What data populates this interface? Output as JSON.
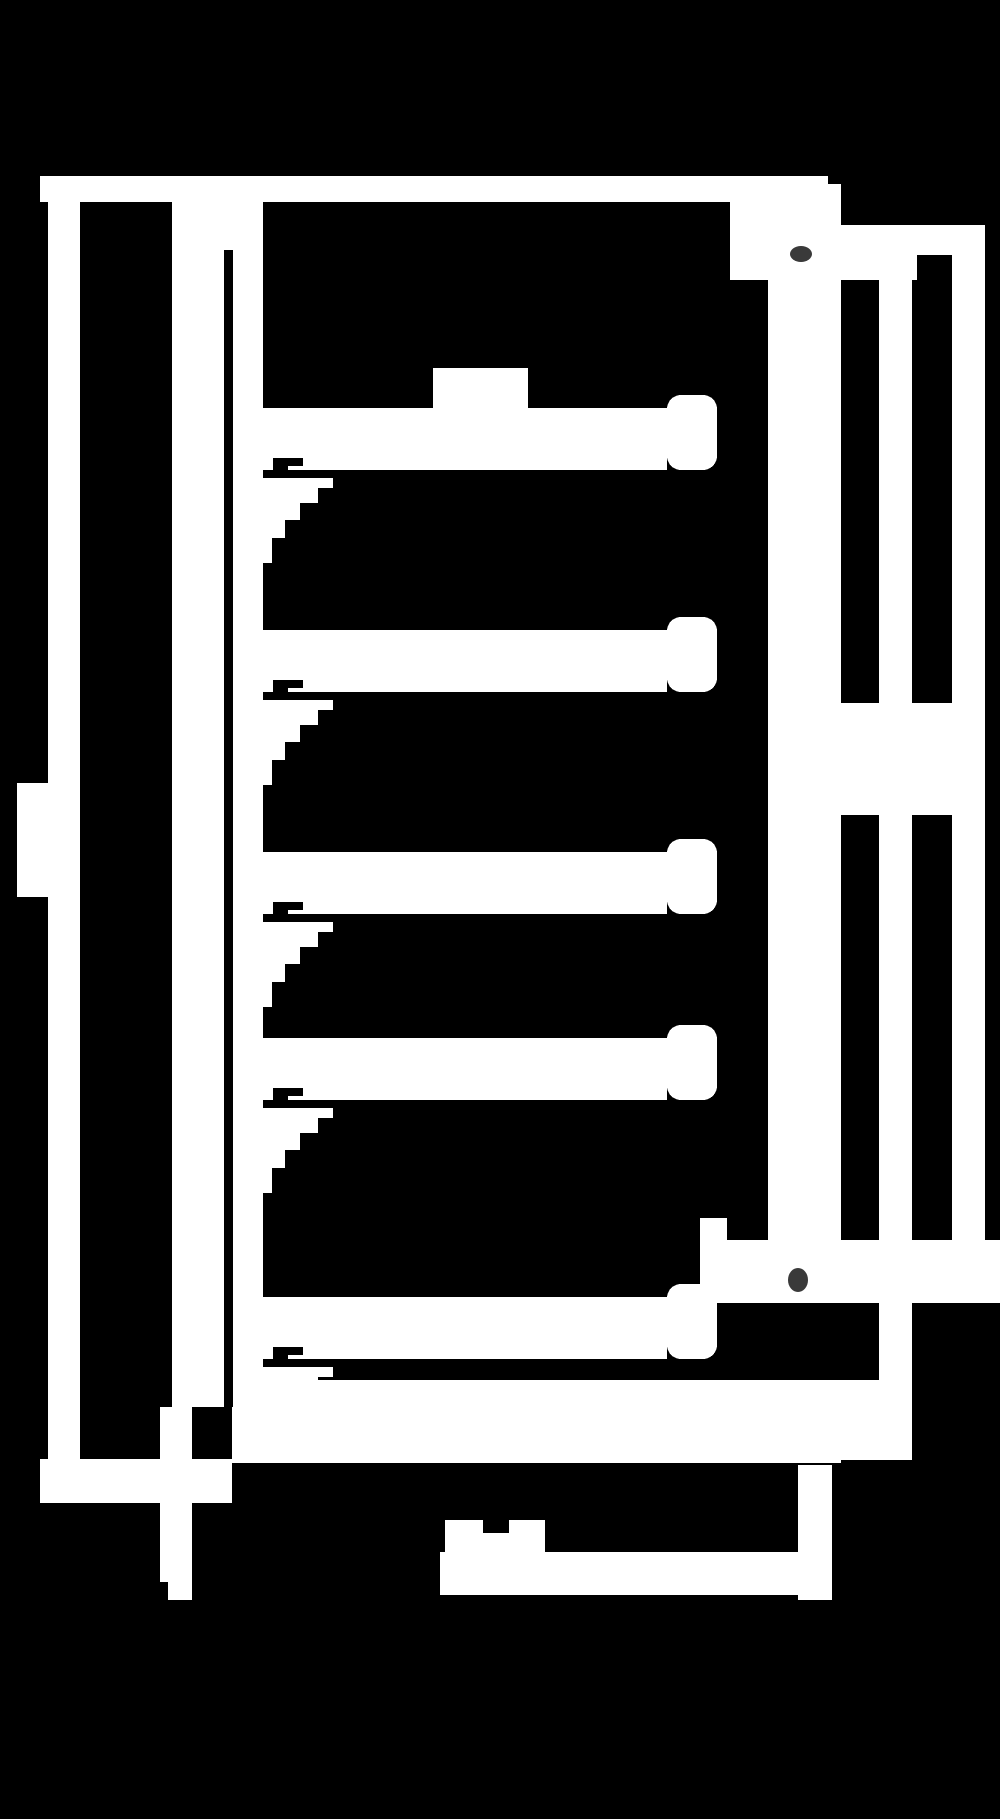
{
  "canvas": {
    "width": 1000,
    "height": 1819,
    "background_color": "#000000",
    "line_color": "#ffffff",
    "artifact_color": "#3a3a3a"
  },
  "diagram": {
    "type": "technical-drawing",
    "style": "inverted monochrome blocky cross-section of a shelved cabinet",
    "text_labels": [],
    "shapes": [
      {
        "name": "top-band",
        "kind": "rect",
        "fill": "fg",
        "x": 40,
        "y": 176,
        "w": 788,
        "h": 26
      },
      {
        "name": "top-right-block",
        "kind": "rect",
        "fill": "fg",
        "x": 730,
        "y": 176,
        "w": 94,
        "h": 104
      },
      {
        "name": "top-right-step",
        "kind": "rect",
        "fill": "fg",
        "x": 824,
        "y": 184,
        "w": 17,
        "h": 96
      },
      {
        "name": "top-right-wing",
        "kind": "rect",
        "fill": "fg",
        "x": 841,
        "y": 225,
        "w": 144,
        "h": 55
      },
      {
        "name": "left-outer-wall",
        "kind": "rect",
        "fill": "fg",
        "x": 48,
        "y": 202,
        "w": 32,
        "h": 1257
      },
      {
        "name": "door-handle",
        "kind": "rect",
        "fill": "fg",
        "x": 17,
        "y": 783,
        "w": 31,
        "h": 114
      },
      {
        "name": "inner-left-panel",
        "kind": "rect",
        "fill": "fg",
        "x": 172,
        "y": 202,
        "w": 52,
        "h": 1205
      },
      {
        "name": "left-lining",
        "kind": "rect",
        "fill": "fg",
        "x": 233,
        "y": 202,
        "w": 30,
        "h": 1261
      },
      {
        "name": "left-lining-top-merge",
        "kind": "rect",
        "fill": "fg",
        "x": 172,
        "y": 202,
        "w": 91,
        "h": 48
      },
      {
        "name": "shelf-1-bar",
        "kind": "rect",
        "fill": "fg",
        "x": 263,
        "y": 408,
        "w": 404,
        "h": 62
      },
      {
        "name": "shelf-1-lip",
        "kind": "rect",
        "fill": "fg",
        "x": 667,
        "y": 395,
        "w": 50,
        "h": 75,
        "rx": 14
      },
      {
        "name": "shelf-1-block",
        "kind": "rect",
        "fill": "fg",
        "x": 433,
        "y": 368,
        "w": 95,
        "h": 40
      },
      {
        "name": "shelf-1-gusset",
        "kind": "polygon",
        "fill": "fg",
        "points": [
          [
            263,
            478
          ],
          [
            333,
            478
          ],
          [
            333,
            488
          ],
          [
            318,
            488
          ],
          [
            318,
            503
          ],
          [
            300,
            503
          ],
          [
            300,
            520
          ],
          [
            285,
            520
          ],
          [
            285,
            538
          ],
          [
            272,
            538
          ],
          [
            272,
            563
          ],
          [
            263,
            563
          ]
        ]
      },
      {
        "name": "shelf-2-bar",
        "kind": "rect",
        "fill": "fg",
        "x": 263,
        "y": 630,
        "w": 404,
        "h": 62
      },
      {
        "name": "shelf-2-lip",
        "kind": "rect",
        "fill": "fg",
        "x": 667,
        "y": 617,
        "w": 50,
        "h": 75,
        "rx": 14
      },
      {
        "name": "shelf-2-gusset",
        "kind": "polygon",
        "fill": "fg",
        "points": [
          [
            263,
            700
          ],
          [
            333,
            700
          ],
          [
            333,
            710
          ],
          [
            318,
            710
          ],
          [
            318,
            725
          ],
          [
            300,
            725
          ],
          [
            300,
            742
          ],
          [
            285,
            742
          ],
          [
            285,
            760
          ],
          [
            272,
            760
          ],
          [
            272,
            785
          ],
          [
            263,
            785
          ]
        ]
      },
      {
        "name": "shelf-3-bar",
        "kind": "rect",
        "fill": "fg",
        "x": 263,
        "y": 852,
        "w": 404,
        "h": 62
      },
      {
        "name": "shelf-3-lip",
        "kind": "rect",
        "fill": "fg",
        "x": 667,
        "y": 839,
        "w": 50,
        "h": 75,
        "rx": 14
      },
      {
        "name": "shelf-3-gusset",
        "kind": "polygon",
        "fill": "fg",
        "points": [
          [
            263,
            922
          ],
          [
            333,
            922
          ],
          [
            333,
            932
          ],
          [
            318,
            932
          ],
          [
            318,
            947
          ],
          [
            300,
            947
          ],
          [
            300,
            964
          ],
          [
            285,
            964
          ],
          [
            285,
            982
          ],
          [
            272,
            982
          ],
          [
            272,
            1007
          ],
          [
            263,
            1007
          ]
        ]
      },
      {
        "name": "shelf-4-bar",
        "kind": "rect",
        "fill": "fg",
        "x": 263,
        "y": 1038,
        "w": 404,
        "h": 62
      },
      {
        "name": "shelf-4-lip",
        "kind": "rect",
        "fill": "fg",
        "x": 667,
        "y": 1025,
        "w": 50,
        "h": 75,
        "rx": 14
      },
      {
        "name": "shelf-4-gusset",
        "kind": "polygon",
        "fill": "fg",
        "points": [
          [
            263,
            1108
          ],
          [
            333,
            1108
          ],
          [
            333,
            1118
          ],
          [
            318,
            1118
          ],
          [
            318,
            1133
          ],
          [
            300,
            1133
          ],
          [
            300,
            1150
          ],
          [
            285,
            1150
          ],
          [
            285,
            1168
          ],
          [
            272,
            1168
          ],
          [
            272,
            1193
          ],
          [
            263,
            1193
          ]
        ]
      },
      {
        "name": "shelf-5-bar",
        "kind": "rect",
        "fill": "fg",
        "x": 263,
        "y": 1297,
        "w": 404,
        "h": 62
      },
      {
        "name": "shelf-5-lip",
        "kind": "rect",
        "fill": "fg",
        "x": 667,
        "y": 1284,
        "w": 50,
        "h": 75,
        "rx": 14
      },
      {
        "name": "shelf-5-gusset",
        "kind": "polygon",
        "fill": "fg",
        "points": [
          [
            263,
            1367
          ],
          [
            333,
            1367
          ],
          [
            333,
            1377
          ],
          [
            318,
            1377
          ],
          [
            318,
            1392
          ],
          [
            300,
            1392
          ],
          [
            300,
            1409
          ],
          [
            285,
            1409
          ],
          [
            285,
            1427
          ],
          [
            272,
            1427
          ],
          [
            272,
            1452
          ],
          [
            263,
            1452
          ]
        ]
      },
      {
        "name": "right-wall-inner-column",
        "kind": "rect",
        "fill": "fg",
        "x": 768,
        "y": 280,
        "w": 73,
        "h": 960
      },
      {
        "name": "right-wall-middle-column",
        "kind": "rect",
        "fill": "fg",
        "x": 879,
        "y": 280,
        "w": 33,
        "h": 1180
      },
      {
        "name": "right-wall-outer-column",
        "kind": "rect",
        "fill": "fg",
        "x": 952,
        "y": 280,
        "w": 33,
        "h": 1023
      },
      {
        "name": "hinge-bridge",
        "kind": "rect",
        "fill": "fg",
        "x": 841,
        "y": 703,
        "w": 111,
        "h": 112
      },
      {
        "name": "door-bottom-rail",
        "kind": "rect",
        "fill": "fg",
        "x": 700,
        "y": 1240,
        "w": 300,
        "h": 63
      },
      {
        "name": "rail-left-step",
        "kind": "rect",
        "fill": "fg",
        "x": 700,
        "y": 1218,
        "w": 27,
        "h": 22
      },
      {
        "name": "rail-fill-lower",
        "kind": "rect",
        "fill": "fg",
        "x": 841,
        "y": 1380,
        "w": 71,
        "h": 80
      },
      {
        "name": "rail-fill-upper",
        "kind": "rect",
        "fill": "fg",
        "x": 880,
        "y": 1303,
        "w": 32,
        "h": 77
      },
      {
        "name": "floor-slab",
        "kind": "rect",
        "fill": "fg",
        "x": 232,
        "y": 1380,
        "w": 609,
        "h": 83
      },
      {
        "name": "base-island",
        "kind": "rect",
        "fill": "fg",
        "x": 445,
        "y": 1520,
        "w": 100,
        "h": 40
      },
      {
        "name": "base-band",
        "kind": "rect",
        "fill": "fg",
        "x": 440,
        "y": 1552,
        "w": 358,
        "h": 43
      },
      {
        "name": "base-right-column",
        "kind": "rect",
        "fill": "fg",
        "x": 798,
        "y": 1465,
        "w": 34,
        "h": 135
      },
      {
        "name": "pedestal",
        "kind": "rect",
        "fill": "fg",
        "x": 160,
        "y": 1407,
        "w": 32,
        "h": 175
      },
      {
        "name": "pedestal-foot",
        "kind": "rect",
        "fill": "fg",
        "x": 168,
        "y": 1582,
        "w": 24,
        "h": 18
      },
      {
        "name": "foot-band",
        "kind": "rect",
        "fill": "fg",
        "x": 40,
        "y": 1459,
        "w": 192,
        "h": 44
      },
      {
        "name": "wall-gap-line",
        "kind": "rect",
        "fill": "bg",
        "x": 224,
        "y": 250,
        "w": 9,
        "h": 1157
      },
      {
        "name": "top-right-notch",
        "kind": "rect",
        "fill": "bg",
        "x": 917,
        "y": 255,
        "w": 35,
        "h": 25
      },
      {
        "name": "shelf-1-wedge-notch",
        "kind": "polygon",
        "fill": "bg",
        "points": [
          [
            273,
            458
          ],
          [
            303,
            458
          ],
          [
            303,
            466
          ],
          [
            288,
            466
          ],
          [
            288,
            477
          ],
          [
            273,
            477
          ]
        ]
      },
      {
        "name": "shelf-2-wedge-notch",
        "kind": "polygon",
        "fill": "bg",
        "points": [
          [
            273,
            680
          ],
          [
            303,
            680
          ],
          [
            303,
            688
          ],
          [
            288,
            688
          ],
          [
            288,
            699
          ],
          [
            273,
            699
          ]
        ]
      },
      {
        "name": "shelf-3-wedge-notch",
        "kind": "polygon",
        "fill": "bg",
        "points": [
          [
            273,
            902
          ],
          [
            303,
            902
          ],
          [
            303,
            910
          ],
          [
            288,
            910
          ],
          [
            288,
            921
          ],
          [
            273,
            921
          ]
        ]
      },
      {
        "name": "shelf-4-wedge-notch",
        "kind": "polygon",
        "fill": "bg",
        "points": [
          [
            273,
            1088
          ],
          [
            303,
            1088
          ],
          [
            303,
            1096
          ],
          [
            288,
            1096
          ],
          [
            288,
            1107
          ],
          [
            273,
            1107
          ]
        ]
      },
      {
        "name": "shelf-5-wedge-notch",
        "kind": "polygon",
        "fill": "bg",
        "points": [
          [
            273,
            1347
          ],
          [
            303,
            1347
          ],
          [
            303,
            1355
          ],
          [
            288,
            1355
          ],
          [
            288,
            1366
          ],
          [
            273,
            1366
          ]
        ]
      },
      {
        "name": "slab-bottom-dash",
        "kind": "rect",
        "fill": "bg",
        "x": 705,
        "y": 1463,
        "w": 47,
        "h": 9
      },
      {
        "name": "island-notch",
        "kind": "rect",
        "fill": "bg",
        "x": 483,
        "y": 1520,
        "w": 26,
        "h": 13
      },
      {
        "name": "artifact-dot-top",
        "kind": "ellipse",
        "fill": "artifact",
        "cx": 801,
        "cy": 254,
        "rx": 11,
        "ry": 8
      },
      {
        "name": "artifact-dot-bottom",
        "kind": "ellipse",
        "fill": "artifact",
        "cx": 798,
        "cy": 1280,
        "rx": 10,
        "ry": 12
      }
    ]
  }
}
